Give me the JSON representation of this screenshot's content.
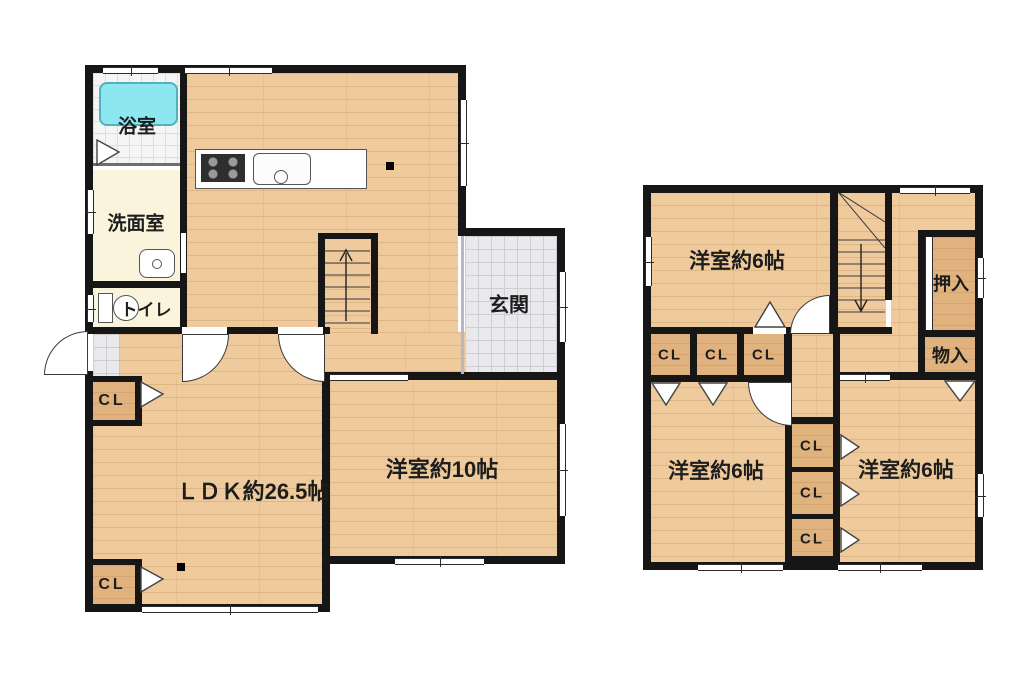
{
  "plan": {
    "floor1": {
      "bath": "浴室",
      "washroom": "洗面室",
      "toilet": "トイレ",
      "entrance": "玄関",
      "ldk": "ＬＤＫ約26.5帖",
      "western10": "洋室約10帖",
      "closet": "CL"
    },
    "floor2": {
      "western6": "洋室約6帖",
      "oshiire": "押入",
      "monoire": "物入",
      "closet": "CL"
    },
    "colors": {
      "wall": "#161616",
      "wood_floor": "#eeca9c",
      "closet_floor": "#e0b27e",
      "bathtub": "#8ce7f1",
      "entrance_tile": "#e9e9ec",
      "cream_floor": "#faf4dc"
    }
  }
}
